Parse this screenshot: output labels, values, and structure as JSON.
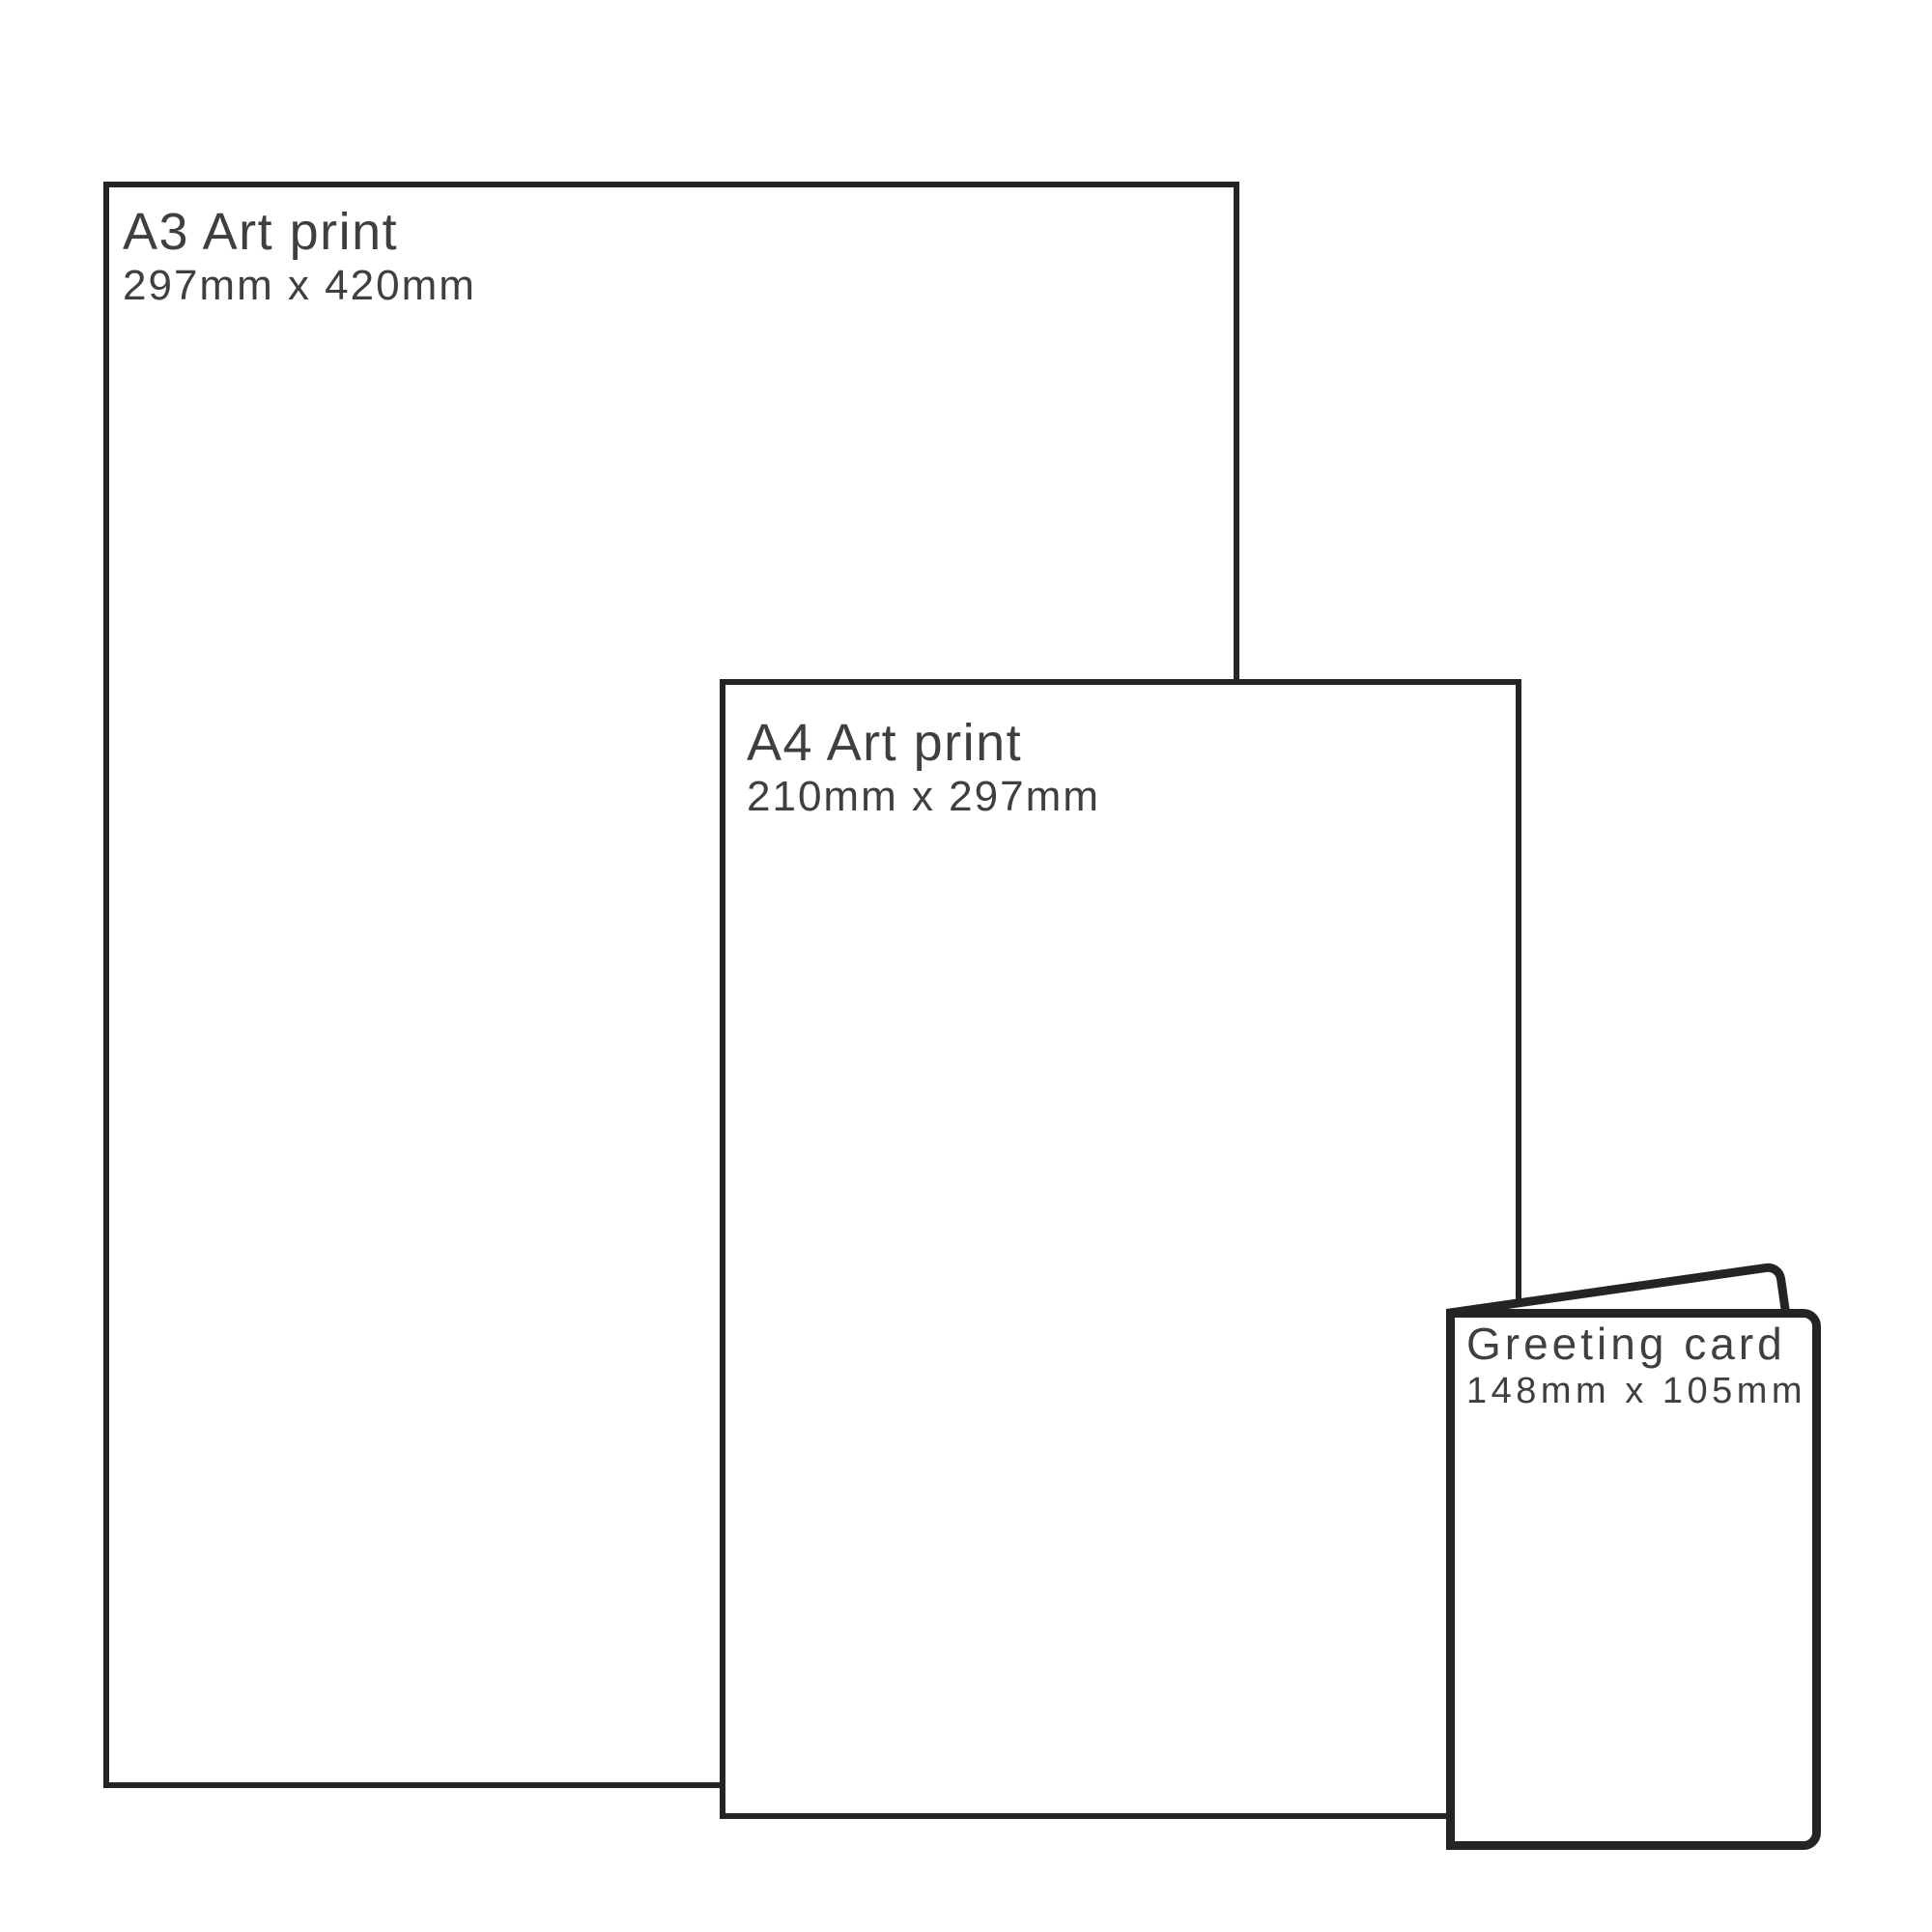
{
  "colors": {
    "background": "#ffffff",
    "outline": "#242424",
    "text": "#3f3f3f"
  },
  "items": [
    {
      "id": "a3",
      "title": "A3 Art print",
      "dimensions": "297mm x 420mm"
    },
    {
      "id": "a4",
      "title": "A4 Art print",
      "dimensions": "210mm x 297mm"
    },
    {
      "id": "greeting-card",
      "title": "Greeting card",
      "dimensions": "148mm x 105mm"
    }
  ]
}
